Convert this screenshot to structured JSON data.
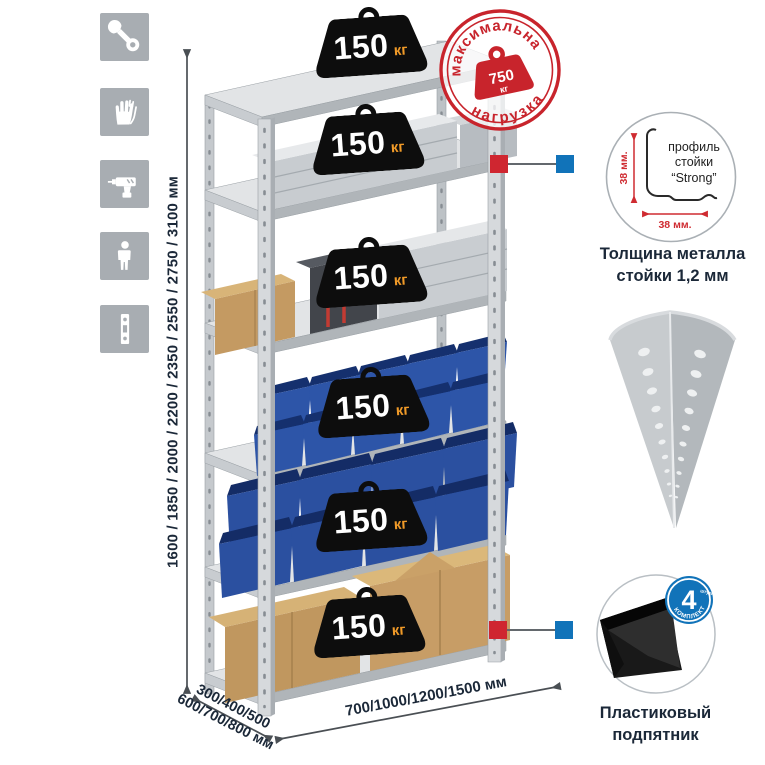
{
  "window": {
    "background": "#ffffff"
  },
  "assembly_icons": [
    {
      "name": "wrench-icon"
    },
    {
      "name": "gloves-icon"
    },
    {
      "name": "drill-icon"
    },
    {
      "name": "person-icon"
    },
    {
      "name": "post-profile-icon"
    }
  ],
  "height_dimension": {
    "label": "1600 / 1850 / 2000 / 2200 / 2350 / 2550 / 2750 / 3100 мм"
  },
  "rack": {
    "shelf_badges": [
      {
        "value": "150",
        "unit": "кг"
      },
      {
        "value": "150",
        "unit": "кг"
      },
      {
        "value": "150",
        "unit": "кг"
      },
      {
        "value": "150",
        "unit": "кг"
      },
      {
        "value": "150",
        "unit": "кг"
      },
      {
        "value": "150",
        "unit": "кг"
      }
    ],
    "max_load_stamp": {
      "arc_top": "максимальная",
      "arc_bottom": "нагрузка",
      "value": "750",
      "unit": "кг"
    }
  },
  "width_dimension": {
    "label": "700/1000/1200/1500 мм"
  },
  "depth_dimension": {
    "line1": "300/400/500",
    "line2": "600/700/800 мм"
  },
  "profile_detail": {
    "vertical_dim": "38 мм.",
    "horizontal_dim": "38 мм.",
    "label_line1": "профиль",
    "label_line2": "стойки",
    "label_line3": "“Strong”",
    "caption_line1": "Толщина металла",
    "caption_line2": "стойки 1,2 мм"
  },
  "foot_detail": {
    "badge_value": "4",
    "badge_note": "штуки",
    "badge_arc": "в комплекте",
    "caption_line1": "Пластиковый",
    "caption_line2": "подпятник"
  },
  "colors": {
    "icon_gray": "#a8adb2",
    "metal_light": "#d6d9dc",
    "metal_mid": "#b9bec2",
    "stamp_red": "#c8242c",
    "accent_blue": "#1173b9",
    "bin_blue": "#2d55a8",
    "cardboard": "#c49a62",
    "text_navy": "#1b2838",
    "badge_black": "#0d0d0d",
    "badge_unit_orange": "#f09a28"
  }
}
